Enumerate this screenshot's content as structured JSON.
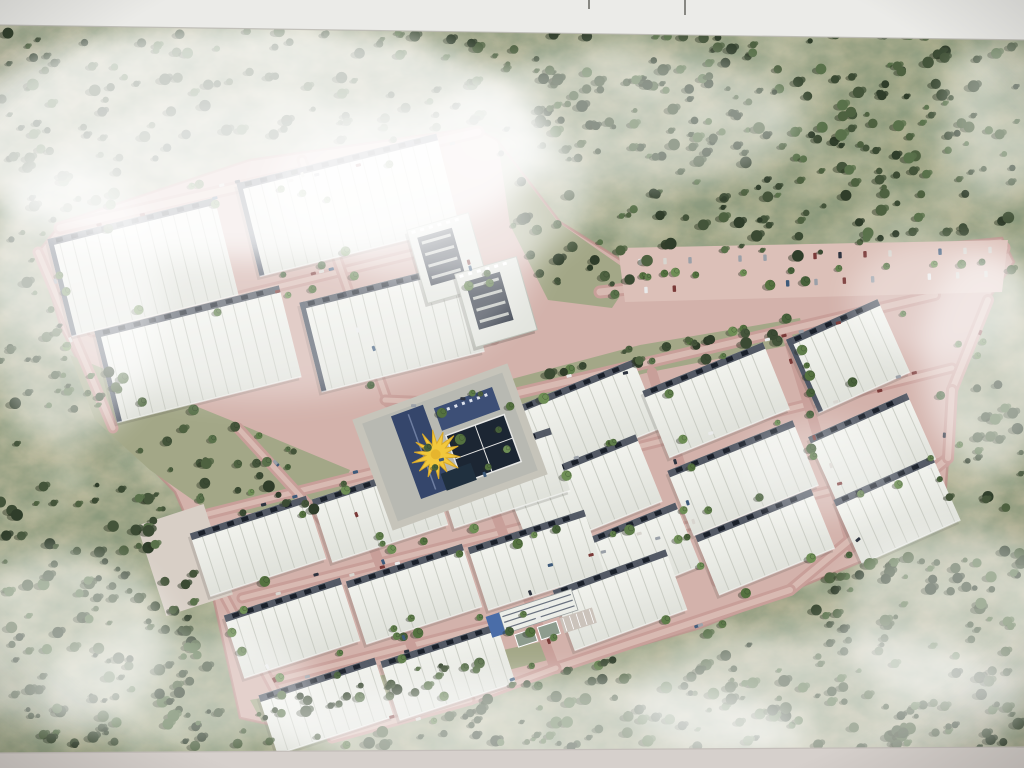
{
  "photo": {
    "description": "aerial-masterplan-rendering-of-industrial-warehouse-park",
    "palette": {
      "paper_top": "#ebebe8",
      "paper_bottom": "#d6d0cc",
      "paper_edge": "#b9b7b1",
      "terrain_a": "#bdbaa0",
      "terrain_b": "#a8ab8b",
      "terrain_c": "#b2af95",
      "mottle_dark_r": 0.23,
      "mottle_dark_g": 0.3,
      "mottle_dark_b": 0.19,
      "road": "#d3b2ab",
      "road_line": "#c89f99",
      "road_center": "#d8bab2",
      "road_edge": "#bb8e89",
      "parking": "#dcc0b8",
      "apron": "#d8cfc6",
      "roof_top": "#f3f4ef",
      "roof_bottom": "#dfe1da",
      "panel": "#c5c8bf",
      "dock": "#454c59",
      "dock_sq": "#1a202a",
      "left_strip": "#4e5664",
      "navy": "#35466b",
      "navy2": "#3d4f76",
      "court": "#1c2633",
      "court_line": "#e8e8e6",
      "canopy_yellow": "#f2c83c",
      "canopy_edge": "#d9a92c",
      "office_roof": "#e3e5df",
      "office_court": "#363d49",
      "office_blue": "#4a6da8",
      "green_overlay": "#a3a787",
      "forest_trees": [
        "#3b4a33",
        "#2f3d2a",
        "#4e6140",
        "#59714a",
        "#44543a"
      ],
      "street_trees": [
        "#5f7d4a",
        "#54713f",
        "#6e8e55",
        "#47603a"
      ],
      "tree_shadow": "#2a3322",
      "car_colors": [
        "#e9eaea",
        "#2e3440",
        "#9aa0a8",
        "#7a3a38",
        "#3d5a7a",
        "#d8d5cf"
      ]
    },
    "paper": {
      "top_band": [
        [
          0,
          0
        ],
        [
          1024,
          0
        ],
        [
          1024,
          40
        ],
        [
          0,
          25
        ]
      ],
      "bottom_band": [
        [
          0,
          753
        ],
        [
          1024,
          747
        ],
        [
          1024,
          768
        ],
        [
          0,
          768
        ]
      ],
      "marks": [
        {
          "x": 588,
          "y": 0,
          "h": 9
        },
        {
          "x": 684,
          "y": 0,
          "h": 15
        }
      ]
    },
    "terrain": {
      "seed": 11,
      "base_count": 230,
      "dense_regions": [
        [
          0,
          28,
          1024,
          110,
          170
        ],
        [
          620,
          120,
          404,
          170,
          130
        ],
        [
          540,
          60,
          200,
          100,
          40
        ],
        [
          700,
          380,
          324,
          210,
          110
        ],
        [
          0,
          480,
          200,
          280,
          120
        ],
        [
          150,
          600,
          300,
          160,
          90
        ],
        [
          420,
          660,
          380,
          100,
          80
        ],
        [
          800,
          560,
          224,
          195,
          90
        ],
        [
          0,
          150,
          120,
          260,
          60
        ]
      ]
    },
    "site": {
      "footprint": [
        [
          38,
          252
        ],
        [
          62,
          222
        ],
        [
          250,
          160
        ],
        [
          474,
          128
        ],
        [
          497,
          140
        ],
        [
          560,
          222
        ],
        [
          640,
          272
        ],
        [
          1002,
          238
        ],
        [
          1014,
          262
        ],
        [
          988,
          300
        ],
        [
          952,
          390
        ],
        [
          948,
          458
        ],
        [
          943,
          525
        ],
        [
          870,
          558
        ],
        [
          788,
          592
        ],
        [
          700,
          628
        ],
        [
          560,
          668
        ],
        [
          470,
          700
        ],
        [
          332,
          738
        ],
        [
          296,
          730
        ],
        [
          240,
          718
        ],
        [
          205,
          560
        ],
        [
          175,
          492
        ],
        [
          113,
          428
        ],
        [
          62,
          330
        ]
      ],
      "green_overlays": [
        {
          "name": "green-band-west",
          "pts": [
            [
              70,
              355
            ],
            [
              230,
              420
            ],
            [
              350,
              470
            ],
            [
              330,
              515
            ],
            [
              210,
              512
            ],
            [
              150,
              470
            ],
            [
              95,
              420
            ]
          ],
          "trees": 26
        },
        {
          "name": "green-wedge-ne",
          "pts": [
            [
              498,
              143
            ],
            [
              558,
              222
            ],
            [
              634,
              275
            ],
            [
              612,
              308
            ],
            [
              548,
              300
            ],
            [
              510,
              225
            ]
          ],
          "trees": 14
        },
        {
          "name": "landscape-band-spine",
          "pts": [
            [
              470,
              390
            ],
            [
              640,
              345
            ],
            [
              800,
              318
            ],
            [
              806,
              342
            ],
            [
              650,
              372
            ],
            [
              482,
              414
            ]
          ],
          "trees": 16
        },
        {
          "name": "green-strip-south",
          "pts": [
            [
              250,
              700
            ],
            [
              420,
              668
            ],
            [
              540,
              642
            ],
            [
              548,
              660
            ],
            [
              430,
              690
            ],
            [
              262,
              722
            ]
          ],
          "trees": 12
        }
      ],
      "streets": [
        {
          "x1": 60,
          "y1": 228,
          "x2": 478,
          "y2": 132,
          "w": 13,
          "trees": 8,
          "cars": 9
        },
        {
          "x1": 92,
          "y1": 332,
          "x2": 470,
          "y2": 240,
          "w": 11,
          "trees": 6,
          "cars": 4
        },
        {
          "x1": 302,
          "y1": 160,
          "x2": 388,
          "y2": 402,
          "w": 11,
          "trees": 5,
          "cars": 4
        },
        {
          "x1": 480,
          "y1": 402,
          "x2": 935,
          "y2": 295,
          "w": 12,
          "trees": 9,
          "cars": 7
        },
        {
          "x1": 498,
          "y1": 482,
          "x2": 952,
          "y2": 368,
          "w": 11,
          "trees": 8,
          "cars": 6
        },
        {
          "x1": 520,
          "y1": 568,
          "x2": 945,
          "y2": 462,
          "w": 11,
          "trees": 8,
          "cars": 6
        },
        {
          "x1": 208,
          "y1": 514,
          "x2": 548,
          "y2": 428,
          "w": 11,
          "trees": 7,
          "cars": 5
        },
        {
          "x1": 242,
          "y1": 598,
          "x2": 582,
          "y2": 512,
          "w": 11,
          "trees": 7,
          "cars": 5
        },
        {
          "x1": 276,
          "y1": 680,
          "x2": 614,
          "y2": 594,
          "w": 11,
          "trees": 7,
          "cars": 4
        },
        {
          "x1": 238,
          "y1": 428,
          "x2": 322,
          "y2": 520,
          "w": 11,
          "trees": 3,
          "cars": 2
        },
        {
          "x1": 652,
          "y1": 372,
          "x2": 716,
          "y2": 582,
          "w": 10,
          "trees": 5,
          "cars": 3
        },
        {
          "x1": 788,
          "y1": 338,
          "x2": 852,
          "y2": 548,
          "w": 10,
          "trees": 5,
          "cars": 3
        },
        {
          "x1": 352,
          "y1": 492,
          "x2": 432,
          "y2": 700,
          "w": 10,
          "trees": 5,
          "cars": 3
        },
        {
          "x1": 474,
          "y1": 458,
          "x2": 554,
          "y2": 666,
          "w": 10,
          "trees": 5,
          "cars": 3
        },
        {
          "x1": 600,
          "y1": 292,
          "x2": 1004,
          "y2": 248,
          "w": 13,
          "trees": 6,
          "cars": 0
        },
        {
          "x1": 385,
          "y1": 400,
          "x2": 482,
          "y2": 404,
          "w": 11,
          "trees": 2,
          "cars": 2
        },
        {
          "x1": 468,
          "y1": 242,
          "x2": 494,
          "y2": 340,
          "w": 11,
          "trees": 3,
          "cars": 2
        },
        {
          "x1": 948,
          "y1": 458,
          "x2": 790,
          "y2": 590,
          "w": 12,
          "trees": 4,
          "cars": 2
        },
        {
          "x1": 790,
          "y1": 590,
          "x2": 556,
          "y2": 668,
          "w": 12,
          "trees": 4,
          "cars": 2
        },
        {
          "x1": 556,
          "y1": 668,
          "x2": 470,
          "y2": 700,
          "w": 11,
          "trees": 2,
          "cars": 1
        },
        {
          "x1": 470,
          "y1": 700,
          "x2": 332,
          "y2": 738,
          "w": 11,
          "trees": 3,
          "cars": 2
        },
        {
          "x1": 38,
          "y1": 252,
          "x2": 113,
          "y2": 428,
          "w": 11,
          "trees": 4,
          "cars": 2
        },
        {
          "x1": 205,
          "y1": 560,
          "x2": 296,
          "y2": 730,
          "w": 11,
          "trees": 4,
          "cars": 2
        },
        {
          "x1": 988,
          "y1": 300,
          "x2": 952,
          "y2": 390,
          "w": 12,
          "trees": 3,
          "cars": 1
        },
        {
          "x1": 952,
          "y1": 390,
          "x2": 948,
          "y2": 458,
          "w": 12,
          "trees": 2,
          "cars": 1
        }
      ],
      "parking_ne": {
        "poly": [
          [
            618,
            248
          ],
          [
            1008,
            240
          ],
          [
            1002,
            292
          ],
          [
            625,
            302
          ]
        ],
        "rows": [
          {
            "x1": 640,
            "y1": 262,
            "x2": 990,
            "y2": 250,
            "n": 15
          },
          {
            "x1": 646,
            "y1": 290,
            "x2": 986,
            "y2": 274,
            "n": 13
          }
        ],
        "trees": 8
      },
      "apron_sw": {
        "cx": 185,
        "cy": 560,
        "w": 70,
        "h": 95,
        "rot": -18
      },
      "sheds": [
        {
          "cx": 143,
          "cy": 267,
          "w": 172,
          "h": 100,
          "rot": -14,
          "ld": 1
        },
        {
          "cx": 348,
          "cy": 205,
          "w": 206,
          "h": 96,
          "rot": -14,
          "ld": 1
        },
        {
          "cx": 198,
          "cy": 354,
          "w": 190,
          "h": 94,
          "rot": -14,
          "ld": 1
        },
        {
          "cx": 392,
          "cy": 327,
          "w": 168,
          "h": 92,
          "rot": -14,
          "ld": 1
        },
        {
          "cx": 582,
          "cy": 420,
          "w": 140,
          "h": 74,
          "rot": -22,
          "ld": 0
        },
        {
          "cx": 716,
          "cy": 400,
          "w": 130,
          "h": 72,
          "rot": -22,
          "ld": 0
        },
        {
          "cx": 584,
          "cy": 494,
          "w": 140,
          "h": 72,
          "rot": -22,
          "ld": 0
        },
        {
          "cx": 743,
          "cy": 478,
          "w": 135,
          "h": 70,
          "rot": -22,
          "ld": 0
        },
        {
          "cx": 624,
          "cy": 560,
          "w": 138,
          "h": 68,
          "rot": -22,
          "ld": 0
        },
        {
          "cx": 765,
          "cy": 542,
          "w": 125,
          "h": 64,
          "rot": -22,
          "ld": 0
        },
        {
          "cx": 848,
          "cy": 356,
          "w": 100,
          "h": 80,
          "rot": -24,
          "ld": 1
        },
        {
          "cx": 872,
          "cy": 448,
          "w": 108,
          "h": 72,
          "rot": -24,
          "ld": 0
        },
        {
          "cx": 897,
          "cy": 510,
          "w": 108,
          "h": 70,
          "rot": -24,
          "ld": 0
        },
        {
          "cx": 258,
          "cy": 546,
          "w": 122,
          "h": 66,
          "rot": -18,
          "ld": 0
        },
        {
          "cx": 380,
          "cy": 512,
          "w": 122,
          "h": 66,
          "rot": -18,
          "ld": 0
        },
        {
          "cx": 502,
          "cy": 478,
          "w": 122,
          "h": 66,
          "rot": -18,
          "ld": 0
        },
        {
          "cx": 292,
          "cy": 628,
          "w": 122,
          "h": 66,
          "rot": -18,
          "ld": 0
        },
        {
          "cx": 414,
          "cy": 594,
          "w": 122,
          "h": 66,
          "rot": -18,
          "ld": 0
        },
        {
          "cx": 536,
          "cy": 560,
          "w": 122,
          "h": 66,
          "rot": -18,
          "ld": 0
        },
        {
          "cx": 326,
          "cy": 706,
          "w": 122,
          "h": 62,
          "rot": -18,
          "ld": 0
        },
        {
          "cx": 448,
          "cy": 672,
          "w": 122,
          "h": 62,
          "rot": -18,
          "ld": 0
        },
        {
          "cx": 620,
          "cy": 600,
          "w": 120,
          "h": 64,
          "rot": -20,
          "ld": 0
        }
      ],
      "offices": {
        "rot": -16,
        "blocks": [
          {
            "cx": 448,
            "cy": 258
          },
          {
            "cx": 496,
            "cy": 302
          }
        ],
        "bw": 64,
        "bh": 76
      },
      "amenity": {
        "cx": 450,
        "cy": 447,
        "rot": -20,
        "pad_w": 165,
        "pad_h": 118,
        "sun_cx": -16,
        "sun_cy": 2,
        "sun_r": 24
      },
      "services": {
        "cx": 540,
        "cy": 616,
        "rot": -18
      }
    },
    "haze": [
      {
        "cx": 250,
        "cy": 140,
        "rx": 300,
        "ry": 120,
        "o": 0.75
      },
      {
        "cx": 260,
        "cy": 250,
        "rx": 280,
        "ry": 150,
        "o": 0.35
      },
      {
        "cx": 70,
        "cy": 300,
        "rx": 90,
        "ry": 140,
        "o": 0.5
      },
      {
        "cx": 430,
        "cy": 190,
        "rx": 160,
        "ry": 90,
        "o": 0.5
      },
      {
        "cx": 620,
        "cy": 120,
        "rx": 180,
        "ry": 70,
        "o": 0.45
      },
      {
        "cx": 1002,
        "cy": 120,
        "rx": 60,
        "ry": 80,
        "o": 0.4
      },
      {
        "cx": 990,
        "cy": 360,
        "rx": 70,
        "ry": 110,
        "o": 0.5
      },
      {
        "cx": 940,
        "cy": 300,
        "rx": 90,
        "ry": 60,
        "o": 0.35
      },
      {
        "cx": 60,
        "cy": 640,
        "rx": 110,
        "ry": 90,
        "o": 0.5
      },
      {
        "cx": 180,
        "cy": 690,
        "rx": 140,
        "ry": 60,
        "o": 0.4
      },
      {
        "cx": 540,
        "cy": 730,
        "rx": 260,
        "ry": 55,
        "o": 0.55
      },
      {
        "cx": 830,
        "cy": 700,
        "rx": 200,
        "ry": 70,
        "o": 0.5
      },
      {
        "cx": 960,
        "cy": 620,
        "rx": 120,
        "ry": 90,
        "o": 0.45
      },
      {
        "cx": 820,
        "cy": 470,
        "rx": 80,
        "ry": 50,
        "o": 0.3
      }
    ]
  }
}
